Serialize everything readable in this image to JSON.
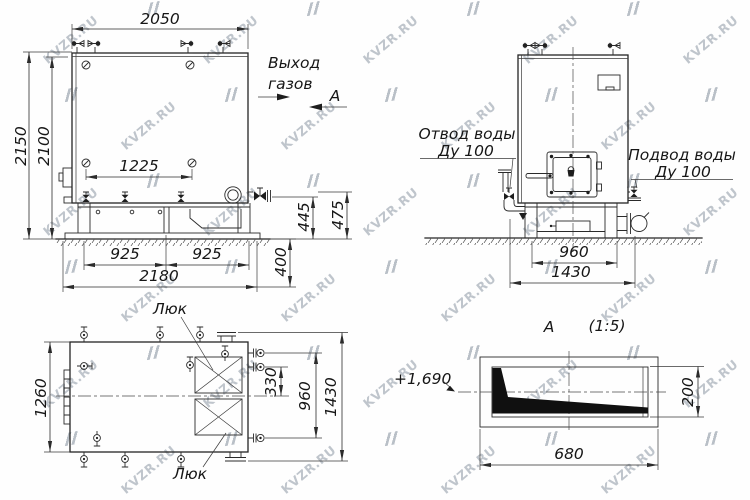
{
  "watermark": {
    "text": "KVZR.RU"
  },
  "front_view": {
    "dim_width_top": "2050",
    "dim_height_overall": "2150",
    "dim_height_body": "2100",
    "dim_valve_spacing": "1225",
    "dim_base_span_left": "925",
    "dim_base_span_right": "925",
    "dim_base_overall": "2180",
    "dim_foundation": "400",
    "dim_outlet_a": "445",
    "dim_outlet_b": "475",
    "label_gas_outlet_line1": "Выход",
    "label_gas_outlet_line2": "газов",
    "label_section_arrow": "А"
  },
  "side_view": {
    "label_water_outlet_line1": "Отвод воды",
    "label_water_outlet_line2": "Ду 100",
    "label_water_inlet_line1": "Подвод воды",
    "label_water_inlet_line2": "Ду 100",
    "dim_base_width": "960",
    "dim_overall_width": "1430"
  },
  "plan_view": {
    "label_hatch_top": "Люк",
    "label_hatch_bottom": "Люк",
    "dim_depth_body": "1260",
    "dim_stub_offset": "330",
    "dim_stub_span": "960",
    "dim_overall_depth": "1430"
  },
  "section_view": {
    "title_letter": "А",
    "title_scale": "(1:5)",
    "label_elevation": "+1,690",
    "dim_height": "200",
    "dim_width": "680"
  }
}
